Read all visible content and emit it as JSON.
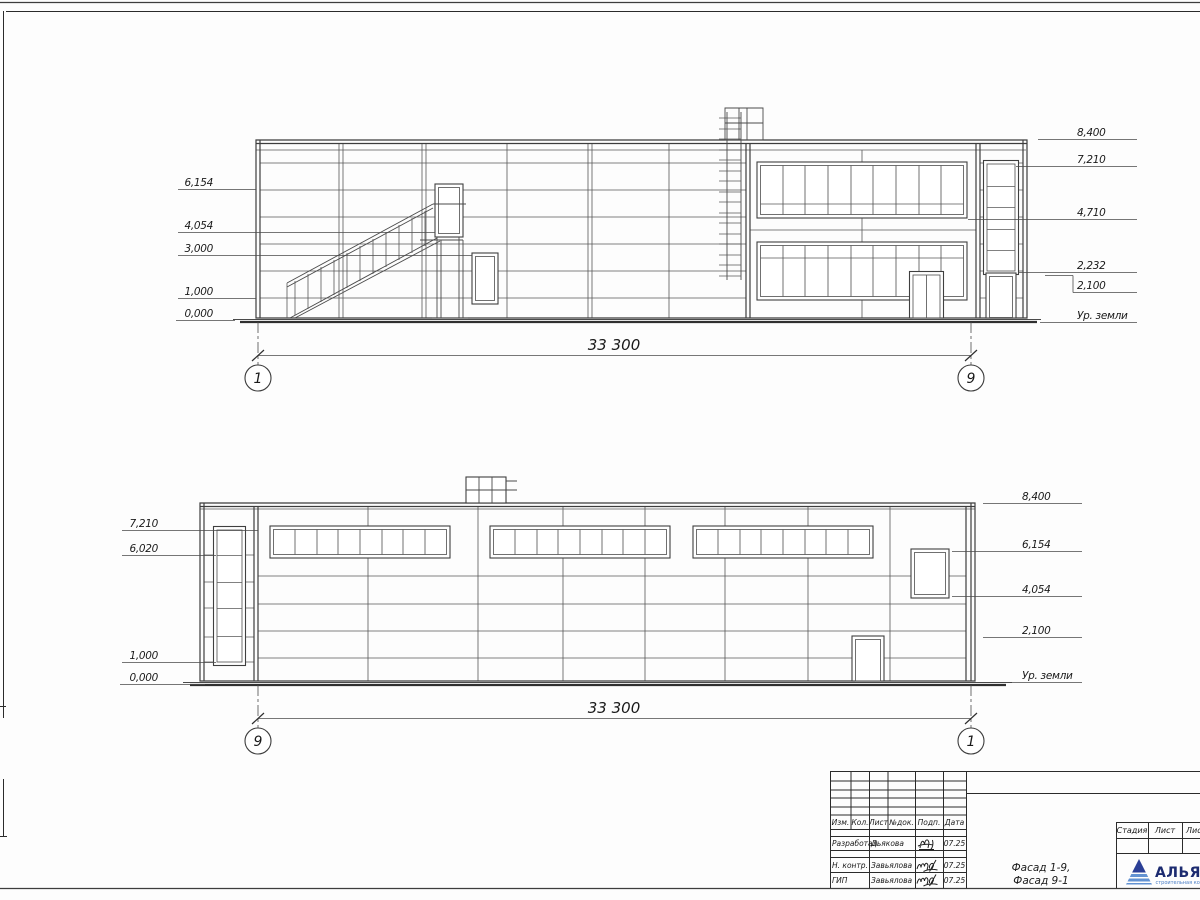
{
  "sheet": {
    "facade_top": {
      "left_levels": [
        "6,154",
        "4,054",
        "3,000",
        "1,000",
        "0,000"
      ],
      "right_levels": [
        "8,400",
        "7,210",
        "4,710",
        "2,232",
        "2,100"
      ],
      "ground_label": "Ур. земли",
      "dimension": "33 300",
      "axis_left": "1",
      "axis_right": "9"
    },
    "facade_bottom": {
      "left_levels": [
        "7,210",
        "6,020",
        "1,000",
        "0,000"
      ],
      "right_levels": [
        "8,400",
        "6,154",
        "4,054",
        "2,100"
      ],
      "ground_label": "Ур. земли",
      "dimension": "33 300",
      "axis_left": "9",
      "axis_right": "1"
    },
    "title_block": {
      "header_cols": [
        "Изм.",
        "Кол.",
        "Лист",
        "№док.",
        "Подп.",
        "Дата"
      ],
      "rows": [
        {
          "role": "Разработал",
          "name": "Дьякова",
          "date": "07.25"
        },
        {
          "role": "Н. контр.",
          "name": "Завьялова",
          "date": "07.25"
        },
        {
          "role": "ГИП",
          "name": "Завьялова",
          "date": "07.25"
        }
      ],
      "stage_cols": [
        "Стадия",
        "Лист",
        "Листов"
      ],
      "doc_title_line1": "Фасад 1-9,",
      "doc_title_line2": "Фасад 9-1",
      "company_name": "АЛЬЯНС",
      "company_subtitle": "строительная компания",
      "logo_dark": "#2b3f96",
      "logo_light": "#6292d2"
    }
  }
}
